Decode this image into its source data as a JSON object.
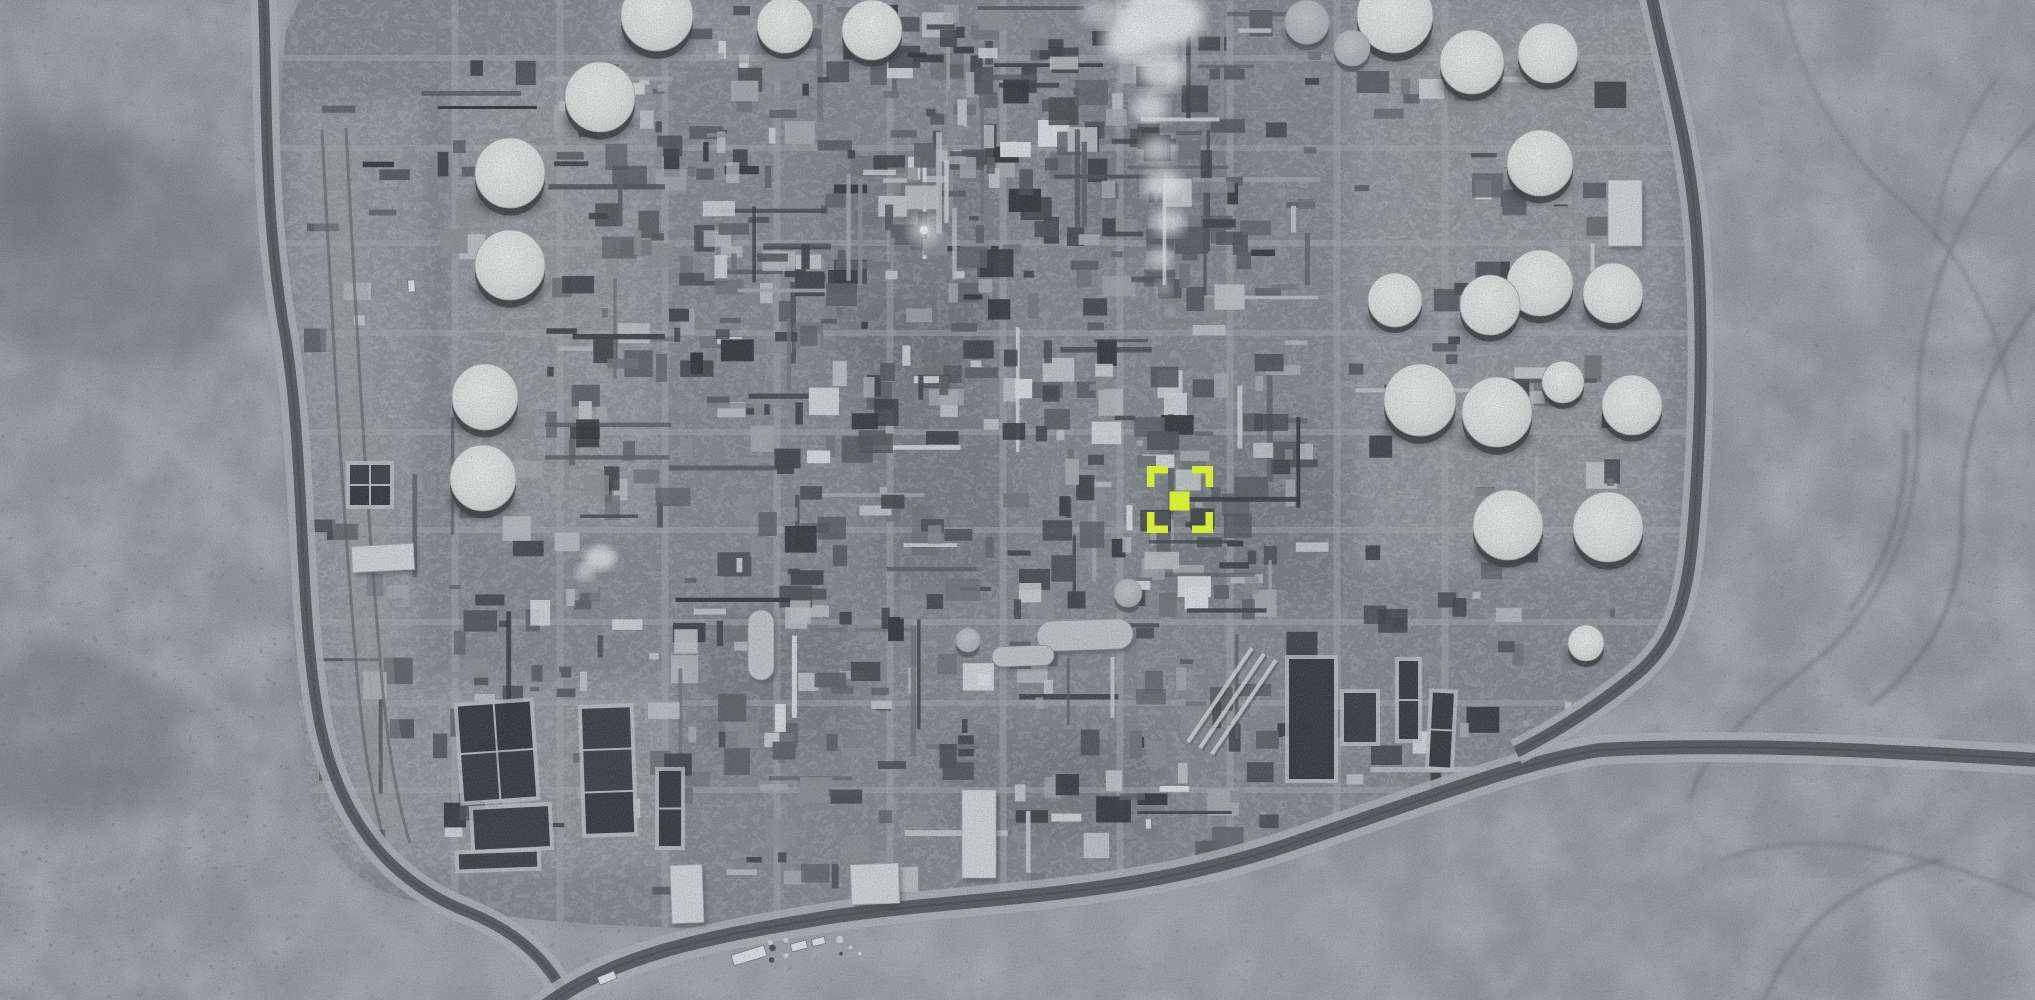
{
  "image": {
    "width": 2035,
    "height": 1000,
    "kind": "grayscale-satellite-photo-oil-refinery-desert"
  },
  "palette": {
    "desert_base": "#90959a",
    "plant_pad": "#83878a",
    "shadow_dark": "#1e2124",
    "pond_water": "#1d2023",
    "pond_rim": "#c6c9c9",
    "road_light": "#b3b6b7",
    "road_dark": "#43474a",
    "smoke_white": "#f4f5f4",
    "tank_top": "#eeefec",
    "tank_gray": "#b9bcbc",
    "marker_accent": "#d4ec34",
    "clutter_fills": [
      "#26292b",
      "#34383a",
      "#45494b",
      "#55595b",
      "#6a6e70",
      "#8b8f90",
      "#a9acad",
      "#c6c9c9",
      "#dddfdf"
    ],
    "clutter_weights": [
      2,
      3,
      3,
      3,
      2,
      2,
      2,
      2,
      1
    ]
  },
  "marker": {
    "x": 1147,
    "y": 466,
    "width": 66,
    "height": 67,
    "arm": 21,
    "thickness": 7.5,
    "center": {
      "x": 1169.5,
      "y": 491.5,
      "width": 20,
      "height": 19
    },
    "color": "#d4ec34"
  },
  "plant": {
    "pad_path": "M300,0 L1655,0 Q1700,130 1701,300 L1701,480 Q1695,580 1650,655 Q1590,740 1480,780 Q1300,845 1080,890 Q880,915 690,928 Q520,925 400,898 Q330,875 312,800 Q295,700 290,560 Q285,420 280,260 Q277,120 286,30 Z",
    "grid": {
      "vertical_x": [
        455,
        560,
        665,
        777,
        890,
        1003,
        1120,
        1230,
        1337,
        1445
      ],
      "horizontal_y": [
        58,
        148,
        243,
        333,
        432,
        530,
        622,
        703,
        790
      ]
    },
    "districts": [
      {
        "x": 640,
        "y": 4,
        "w": 360,
        "h": 116,
        "density": 1.5
      },
      {
        "x": 905,
        "y": 4,
        "w": 420,
        "h": 316,
        "density": 1.4
      },
      {
        "x": 645,
        "y": 120,
        "w": 355,
        "h": 360,
        "density": 1.6
      },
      {
        "x": 1000,
        "y": 320,
        "w": 330,
        "h": 300,
        "density": 1.5
      },
      {
        "x": 645,
        "y": 480,
        "w": 355,
        "h": 330,
        "density": 1.1
      },
      {
        "x": 1000,
        "y": 620,
        "w": 330,
        "h": 210,
        "density": 0.9
      },
      {
        "x": 545,
        "y": 60,
        "w": 120,
        "h": 500,
        "density": 1.2
      },
      {
        "x": 420,
        "y": 60,
        "w": 125,
        "h": 500,
        "density": 0.45
      },
      {
        "x": 1335,
        "y": 60,
        "w": 300,
        "h": 260,
        "density": 0.5
      },
      {
        "x": 1340,
        "y": 330,
        "w": 300,
        "h": 340,
        "density": 0.45
      },
      {
        "x": 430,
        "y": 560,
        "w": 215,
        "h": 300,
        "density": 0.8
      },
      {
        "x": 300,
        "y": 100,
        "w": 120,
        "h": 760,
        "density": 0.3
      },
      {
        "x": 645,
        "y": 810,
        "w": 640,
        "h": 90,
        "density": 0.5
      },
      {
        "x": 1330,
        "y": 680,
        "w": 260,
        "h": 120,
        "density": 0.5
      }
    ],
    "dark_patches": [
      [
        830,
        160,
        170,
        210
      ],
      [
        1150,
        430,
        200,
        170
      ],
      [
        700,
        610,
        150,
        140
      ],
      [
        950,
        730,
        210,
        110
      ],
      [
        1080,
        90,
        160,
        160
      ],
      [
        870,
        430,
        140,
        160
      ],
      [
        860,
        300,
        120,
        130
      ]
    ],
    "light_pads": [
      [
        455,
        70,
        200,
        460
      ],
      [
        605,
        0,
        310,
        60
      ],
      [
        1350,
        0,
        320,
        330
      ],
      [
        1350,
        330,
        320,
        240
      ],
      [
        420,
        680,
        250,
        190
      ],
      [
        290,
        100,
        130,
        770
      ]
    ],
    "pipes_diagonal": [
      [
        1188,
        742,
        1252,
        648
      ],
      [
        1200,
        748,
        1264,
        654
      ],
      [
        1212,
        754,
        1276,
        660
      ]
    ]
  },
  "tanks": [
    [
      600,
      97,
      35,
      0
    ],
    [
      510,
      173,
      35,
      0
    ],
    [
      510,
      265,
      35,
      0
    ],
    [
      485,
      397,
      33,
      0
    ],
    [
      483,
      478,
      33,
      0
    ],
    [
      657,
      15,
      36,
      0
    ],
    [
      785,
      25,
      28,
      0
    ],
    [
      872,
      30,
      30,
      0
    ],
    [
      1395,
      15,
      38,
      0
    ],
    [
      1472,
      62,
      32,
      0
    ],
    [
      1548,
      53,
      30,
      0
    ],
    [
      1540,
      163,
      33,
      0
    ],
    [
      1540,
      283,
      33,
      0
    ],
    [
      1613,
      293,
      30,
      0
    ],
    [
      1395,
      300,
      27,
      0
    ],
    [
      1490,
      305,
      30,
      0
    ],
    [
      1420,
      400,
      36,
      0
    ],
    [
      1497,
      412,
      35,
      0
    ],
    [
      1563,
      382,
      21,
      0
    ],
    [
      1632,
      405,
      30,
      0
    ],
    [
      1508,
      525,
      35,
      0
    ],
    [
      1608,
      527,
      35,
      0
    ],
    [
      1586,
      643,
      18,
      0
    ],
    [
      1307,
      22,
      22,
      1
    ],
    [
      1352,
      48,
      18,
      1
    ],
    [
      1128,
      593,
      14,
      1
    ],
    [
      968,
      640,
      12,
      1
    ]
  ],
  "bullets": [
    [
      1037,
      620,
      96,
      30,
      -2
    ],
    [
      992,
      646,
      62,
      20,
      -2
    ],
    [
      748,
      610,
      26,
      70,
      0
    ]
  ],
  "buildings": [
    [
      1608,
      180,
      34,
      66,
      0
    ],
    [
      671,
      865,
      32,
      58,
      -2
    ],
    [
      851,
      864,
      48,
      40,
      -2
    ],
    [
      962,
      790,
      34,
      88,
      0
    ],
    [
      352,
      545,
      62,
      26,
      -3
    ]
  ],
  "ponds": [
    {
      "x": 460,
      "y": 703,
      "w": 74,
      "h": 97,
      "rot": -4,
      "rows": 2,
      "cols": 2
    },
    {
      "x": 473,
      "y": 807,
      "w": 77,
      "h": 42,
      "rot": -3,
      "rows": 1,
      "cols": 1
    },
    {
      "x": 458,
      "y": 852,
      "w": 80,
      "h": 17,
      "rot": -2,
      "rows": 1,
      "cols": 1
    },
    {
      "x": 583,
      "y": 707,
      "w": 50,
      "h": 127,
      "rot": -2,
      "rows": 3,
      "cols": 1
    },
    {
      "x": 1288,
      "y": 658,
      "w": 47,
      "h": 122,
      "rot": 0,
      "rows": 1,
      "cols": 1
    },
    {
      "x": 1343,
      "y": 692,
      "w": 34,
      "h": 51,
      "rot": 0,
      "rows": 1,
      "cols": 1
    },
    {
      "x": 1398,
      "y": 660,
      "w": 21,
      "h": 80,
      "rot": 0,
      "rows": 2,
      "cols": 1
    },
    {
      "x": 1430,
      "y": 692,
      "w": 23,
      "h": 76,
      "rot": 3,
      "rows": 2,
      "cols": 1
    },
    {
      "x": 658,
      "y": 770,
      "w": 24,
      "h": 77,
      "rot": 0,
      "rows": 2,
      "cols": 1
    },
    {
      "x": 349,
      "y": 464,
      "w": 42,
      "h": 42,
      "rot": 0,
      "rows": 2,
      "cols": 2
    }
  ],
  "roads": [
    {
      "path": "M 263,-12 C 268,90 262,210 286,340 C 306,470 298,610 320,725 C 338,808 380,878 468,912 C 528,936 556,972 572,1010",
      "lw": 26,
      "dw": 11
    },
    {
      "path": "M 540,1010 C 610,956 700,938 830,917 C 980,895 1120,900 1285,846 C 1420,801 1520,762 1600,750 C 1740,742 1900,752 2040,760",
      "lw": 30,
      "dw": 14
    },
    {
      "path": "M 1650,-12 C 1664,60 1690,140 1697,240 C 1704,345 1700,440 1694,520 C 1688,600 1676,640 1638,673 C 1598,706 1556,732 1516,752",
      "lw": 26,
      "dw": 12
    }
  ],
  "corridors": [
    "M 322,130 C 332,320 342,500 356,660 C 362,740 372,800 386,845",
    "M 346,128 C 356,318 366,498 380,658 C 386,738 396,798 410,843"
  ],
  "desert": {
    "washes_light": [
      {
        "path": "M 60,380 C 140,420 220,470 290,540",
        "w": 20
      },
      {
        "path": "M 30,620 C 110,640 190,680 260,740",
        "w": 16
      },
      {
        "path": "M 90,140 C 160,190 220,260 270,340",
        "w": 14
      }
    ],
    "scrub_dark": [
      [
        110,
        250,
        150,
        120
      ],
      [
        40,
        180,
        90,
        70
      ],
      [
        60,
        740,
        120,
        90
      ]
    ],
    "speckle_zones": [
      [
        0,
        0,
        300,
        1000
      ],
      [
        0,
        560,
        620,
        440
      ],
      [
        550,
        930,
        900,
        70
      ],
      [
        1700,
        0,
        335,
        1000
      ]
    ],
    "light_sand": [
      [
        300,
        860,
        420,
        140
      ],
      [
        700,
        880,
        700,
        120
      ]
    ]
  },
  "mountains": {
    "channels_dark": [
      "M 1780,-10 C 1800,80 1840,150 1900,200 C 1960,250 2000,320 2010,400",
      "M 2040,120 C 1960,200 1915,300 1918,420 C 1920,530 1880,610 1810,665 C 1740,718 1700,760 1690,800",
      "M 2040,300 C 1990,360 1960,430 1962,520 C 1963,600 1930,660 1870,705",
      "M 1720,860 C 1800,830 1900,840 2040,900",
      "M 1760,1010 C 1790,930 1850,880 1940,860",
      "M 1905,430 C 1908,500 1890,560 1850,610",
      "M 1995,80 C 1960,130 1940,180 1936,240"
    ],
    "ridges_light": [
      "M 1750,60 C 1820,140 1870,260 1880,380",
      "M 1980,480 C 1940,560 1900,620 1830,680",
      "M 1700,900 C 1780,870 1880,880 1990,930"
    ]
  },
  "smoke": {
    "puffs": [
      [
        1160,
        18,
        44,
        30,
        0.95
      ],
      [
        1128,
        40,
        26,
        20,
        0.9
      ],
      [
        1100,
        12,
        20,
        14,
        0.5
      ],
      [
        1162,
        70,
        24,
        20,
        0.85
      ],
      [
        1150,
        108,
        18,
        16,
        0.8
      ],
      [
        1157,
        150,
        17,
        14,
        0.75
      ],
      [
        1163,
        185,
        20,
        16,
        0.85
      ],
      [
        1168,
        222,
        17,
        14,
        0.8
      ],
      [
        1160,
        258,
        12,
        11,
        0.7
      ],
      [
        1164,
        288,
        8,
        8,
        0.6
      ],
      [
        1170,
        310,
        5,
        5,
        0.5
      ]
    ],
    "flare": {
      "x": 924,
      "y": 230
    },
    "steam": [
      [
        600,
        558,
        16,
        12,
        0.8
      ],
      [
        585,
        572,
        10,
        8,
        0.6
      ]
    ]
  },
  "trucks": [
    [
      732,
      950,
      34,
      11,
      -17
    ],
    [
      791,
      942,
      16,
      8,
      -15
    ],
    [
      812,
      938,
      13,
      7,
      -15
    ],
    [
      598,
      974,
      18,
      8,
      -22
    ],
    [
      408,
      280,
      7,
      12,
      -4
    ]
  ]
}
